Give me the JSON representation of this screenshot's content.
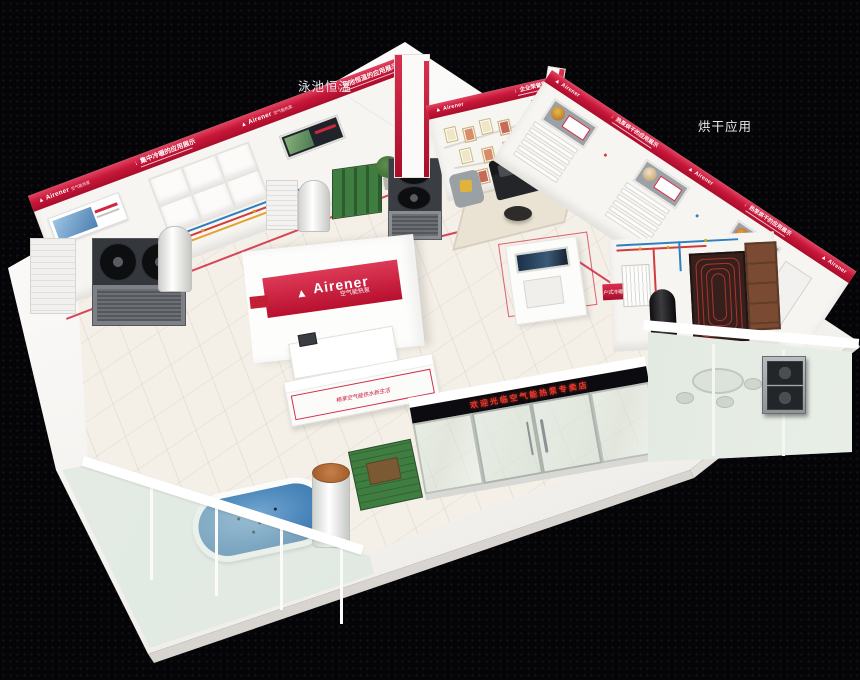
{
  "annotations": {
    "pool": "泳池恒温",
    "drying": "烘干应用"
  },
  "brand": {
    "mark": "▲",
    "name": "Airener",
    "tagline": "空气能热泵"
  },
  "banners": {
    "arrow": "↓",
    "central_hvac": "集中冷暖的应用展示",
    "pool": "泳池恒温的应用展示",
    "honors": "企业荣誉展示",
    "drying": "热泵烘干的应用展示",
    "household": "户式冷暖的应用展示"
  },
  "signs": {
    "led": "欢迎光临空气能热泵专卖店",
    "slogan": "畅享空气能热水新生活"
  },
  "colors": {
    "brand_red": "#c8173a",
    "led_text": "#e8382a",
    "pool_blue": "#4a86ba",
    "panel_green": "#3f7d40",
    "door_brown": "#7a4a32"
  }
}
